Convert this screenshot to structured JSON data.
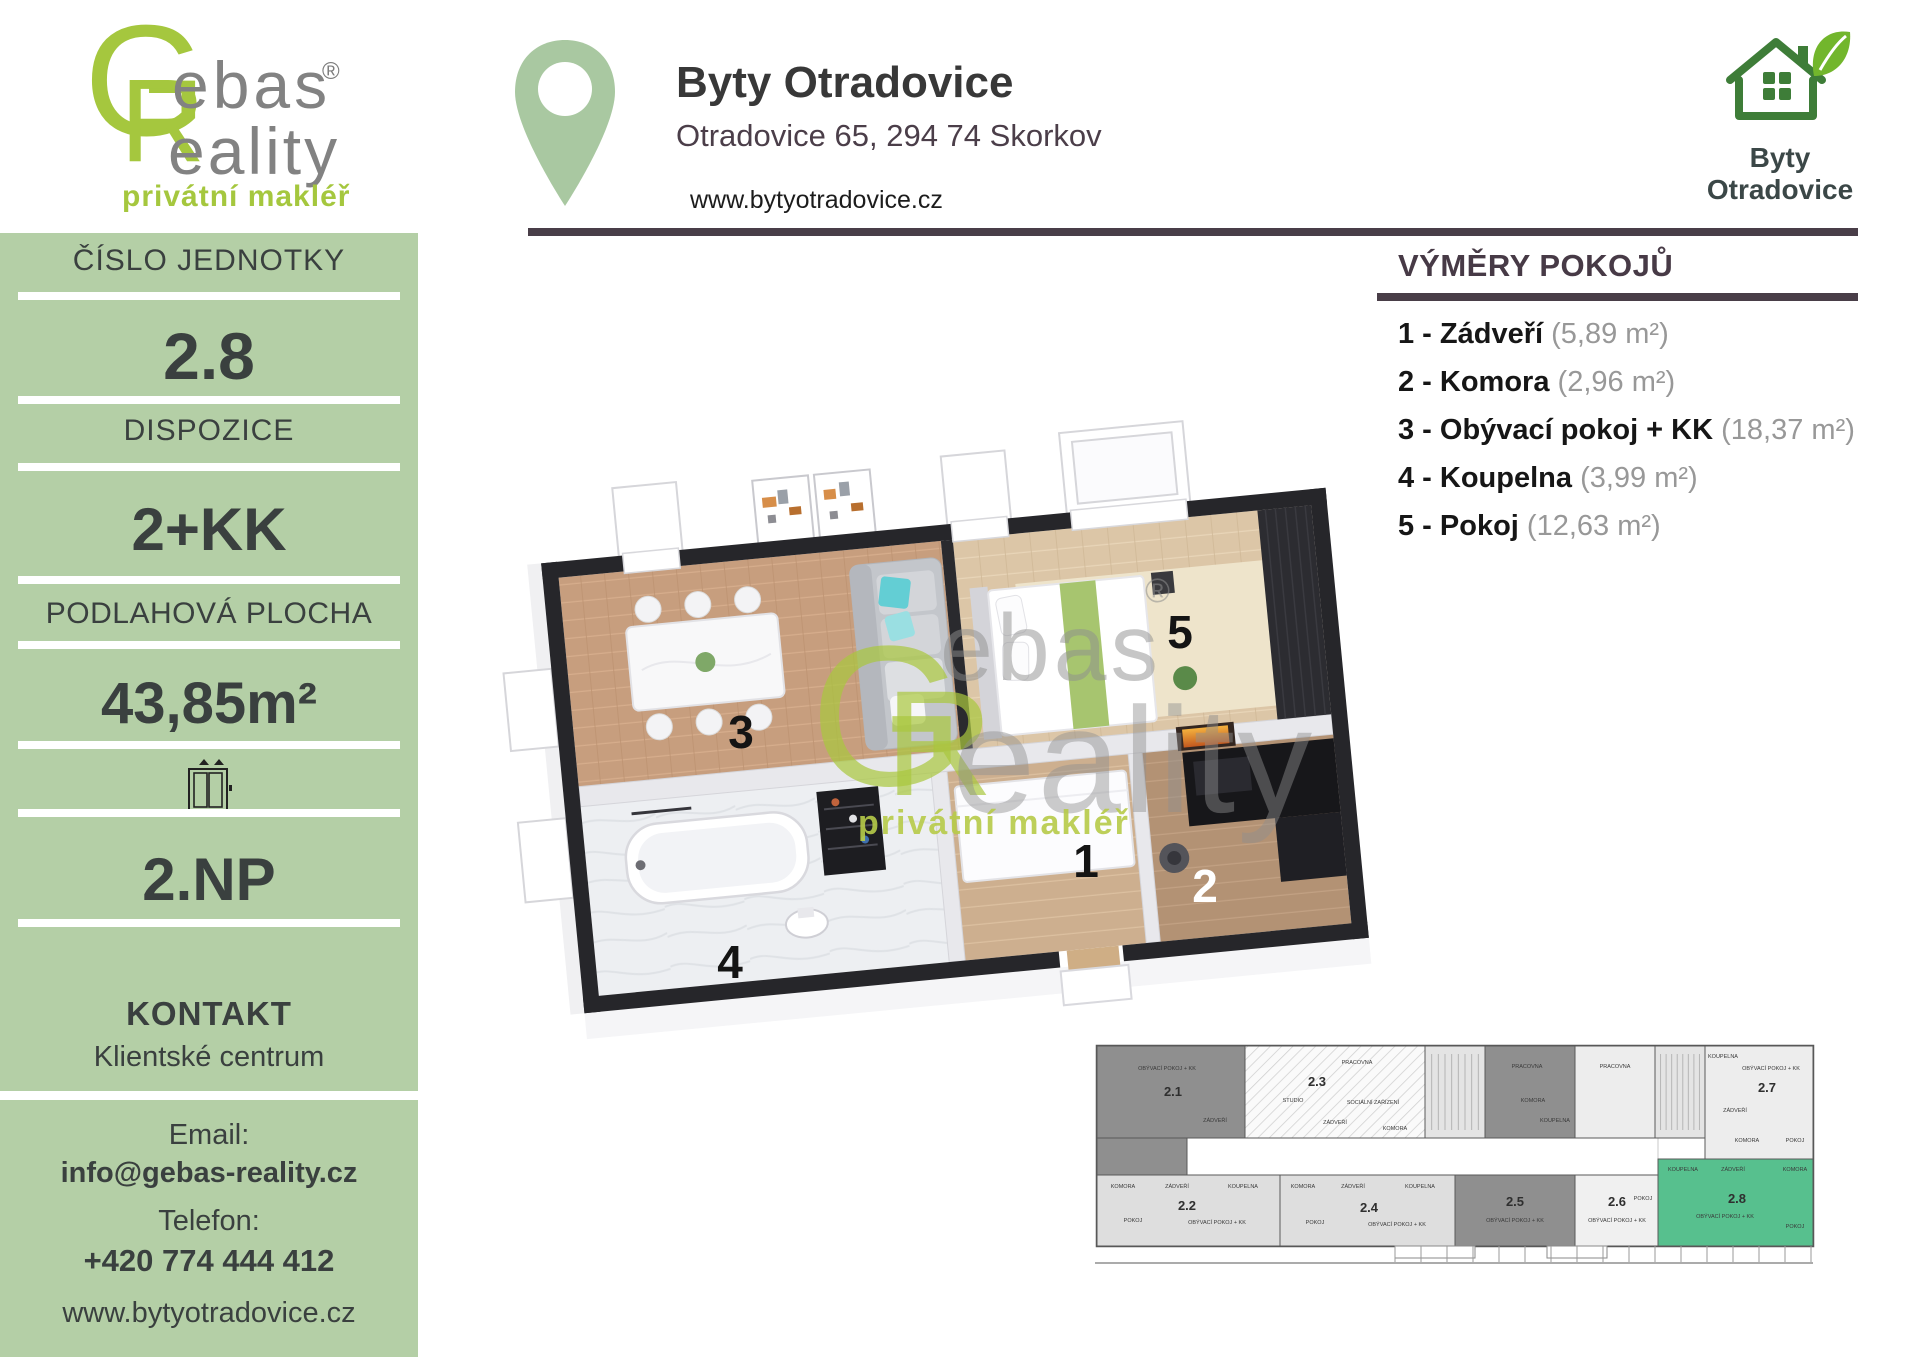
{
  "colors": {
    "sidebar_bg": "#b4cfa6",
    "accent_lime": "#a5c73e",
    "rule_dark": "#493e48",
    "logo_green": "#3e7d38",
    "leaf_green": "#72b62c",
    "pin_green": "#a9c8a1",
    "mini_unit_green": "#57c08e",
    "mini_unit_dark": "#8f8f8f"
  },
  "brand": {
    "monogram_g": "G",
    "monogram_r": "R",
    "word_top": "ebas",
    "word_bottom": "eality",
    "registered": "®",
    "tagline": "privátní makléř"
  },
  "header": {
    "title": "Byty Otradovice",
    "address": "Otradovice 65, 294 74 Skorkov",
    "website": "www.bytyotradovice.cz"
  },
  "logo_right": {
    "line1": "Byty",
    "line2": "Otradovice"
  },
  "sidebar": {
    "unit_label": "ČÍSLO JEDNOTKY",
    "unit_value": "2.8",
    "layout_label": "DISPOZICE",
    "layout_value": "2+KK",
    "area_label": "PODLAHOVÁ PLOCHA",
    "area_value": "43,85m²",
    "floor_value": "2.NP",
    "contact_label": "KONTAKT",
    "contact_name": "Klientské centrum",
    "email_label": "Email:",
    "email": "info@gebas-reality.cz",
    "phone_label": "Telefon:",
    "phone": "+420 774 444 412",
    "website": "www.bytyotradovice.cz"
  },
  "rooms_section": {
    "title": "VÝMĚRY POKOJŮ",
    "items": [
      {
        "name": "1 - Zádveří",
        "area": "(5,89 m²)"
      },
      {
        "name": "2 - Komora",
        "area": "(2,96 m²)"
      },
      {
        "name": "3 - Obývací pokoj + KK",
        "area": "(18,37 m²)"
      },
      {
        "name": "4 - Koupelna",
        "area": "(3,99 m²)"
      },
      {
        "name": "5 - Pokoj",
        "area": "(12,63 m²)"
      }
    ]
  },
  "floor_plan": {
    "labels": [
      {
        "n": "3",
        "x": 251,
        "y": 308,
        "c": "#141414"
      },
      {
        "n": "5",
        "x": 690,
        "y": 208,
        "c": "#141414"
      },
      {
        "n": "4",
        "x": 240,
        "y": 538,
        "c": "#141414"
      },
      {
        "n": "1",
        "x": 596,
        "y": 437,
        "c": "#141414"
      },
      {
        "n": "2",
        "x": 715,
        "y": 462,
        "c": "#ffffff"
      }
    ],
    "watermark": {
      "g": "G",
      "r": "R",
      "word_top": "ebas",
      "word_bottom": "eality",
      "registered": "®",
      "tagline": "privátní makléř"
    }
  },
  "mini_plan": {
    "units": [
      {
        "id": "2.1",
        "x": 2,
        "y": 6,
        "w": 148,
        "h": 92,
        "fill": "#8f8f8f",
        "lx": 78,
        "ly": 56
      },
      {
        "id": "",
        "x": 2,
        "y": 98,
        "w": 90,
        "h": 37,
        "fill": "#8f8f8f"
      },
      {
        "id": "2.3",
        "x": 150,
        "y": 6,
        "w": 180,
        "h": 92,
        "fill": "hatch",
        "lx": 222,
        "ly": 46
      },
      {
        "id": "",
        "x": 330,
        "y": 6,
        "w": 60,
        "h": 92,
        "fill": "#e4e4e4",
        "stairs": true
      },
      {
        "id": "",
        "x": 390,
        "y": 6,
        "w": 90,
        "h": 92,
        "fill": "#8f8f8f"
      },
      {
        "id": "",
        "x": 480,
        "y": 6,
        "w": 80,
        "h": 92,
        "fill": "#ededed"
      },
      {
        "id": "",
        "x": 560,
        "y": 6,
        "w": 50,
        "h": 92,
        "fill": "#e4e4e4",
        "stairs": true
      },
      {
        "id": "2.7",
        "x": 610,
        "y": 6,
        "w": 108,
        "h": 113,
        "fill": "#ededed",
        "lx": 672,
        "ly": 52
      },
      {
        "id": "2.2",
        "x": 2,
        "y": 135,
        "w": 183,
        "h": 71,
        "fill": "#dedede",
        "lx": 92,
        "ly": 170
      },
      {
        "id": "2.4",
        "x": 185,
        "y": 135,
        "w": 175,
        "h": 71,
        "fill": "#dedede",
        "lx": 274,
        "ly": 172
      },
      {
        "id": "2.5",
        "x": 360,
        "y": 135,
        "w": 120,
        "h": 71,
        "fill": "#8f8f8f",
        "lx": 420,
        "ly": 166
      },
      {
        "id": "2.6",
        "x": 480,
        "y": 135,
        "w": 83,
        "h": 71,
        "fill": "#f0f0f0",
        "lx": 522,
        "ly": 166
      },
      {
        "id": "2.8",
        "x": 563,
        "y": 119,
        "w": 155,
        "h": 87,
        "fill": "#57c08e",
        "lx": 642,
        "ly": 163
      }
    ],
    "room_labels": [
      {
        "t": "OBÝVACÍ POKOJ + KK",
        "x": 72,
        "y": 30
      },
      {
        "t": "ZÁDVEŘÍ",
        "x": 120,
        "y": 82
      },
      {
        "t": "STUDIO",
        "x": 198,
        "y": 62
      },
      {
        "t": "PRACOVNA",
        "x": 262,
        "y": 24
      },
      {
        "t": "SOCIÁLNÍ ZAŘÍZENÍ",
        "x": 278,
        "y": 64
      },
      {
        "t": "ZÁDVEŘÍ",
        "x": 240,
        "y": 84
      },
      {
        "t": "KOMORA",
        "x": 300,
        "y": 90
      },
      {
        "t": "PRACOVNA",
        "x": 432,
        "y": 28
      },
      {
        "t": "PRACOVNA",
        "x": 520,
        "y": 28
      },
      {
        "t": "KOMORA",
        "x": 438,
        "y": 62
      },
      {
        "t": "KOUPELNA",
        "x": 460,
        "y": 82
      },
      {
        "t": "KOUPELNA",
        "x": 628,
        "y": 18
      },
      {
        "t": "OBÝVACÍ POKOJ + KK",
        "x": 676,
        "y": 30
      },
      {
        "t": "ZÁDVEŘÍ",
        "x": 640,
        "y": 72
      },
      {
        "t": "KOMORA",
        "x": 652,
        "y": 102
      },
      {
        "t": "POKOJ",
        "x": 700,
        "y": 102
      },
      {
        "t": "KOMORA",
        "x": 28,
        "y": 148
      },
      {
        "t": "ZÁDVEŘÍ",
        "x": 82,
        "y": 148
      },
      {
        "t": "KOUPELNA",
        "x": 148,
        "y": 148
      },
      {
        "t": "POKOJ",
        "x": 38,
        "y": 182
      },
      {
        "t": "OBÝVACÍ POKOJ + KK",
        "x": 122,
        "y": 184
      },
      {
        "t": "KOMORA",
        "x": 208,
        "y": 148
      },
      {
        "t": "ZÁDVEŘÍ",
        "x": 258,
        "y": 148
      },
      {
        "t": "KOUPELNA",
        "x": 325,
        "y": 148
      },
      {
        "t": "POKOJ",
        "x": 220,
        "y": 184
      },
      {
        "t": "OBÝVACÍ POKOJ + KK",
        "x": 302,
        "y": 186
      },
      {
        "t": "OBÝVACÍ POKOJ + KK",
        "x": 420,
        "y": 182
      },
      {
        "t": "OBÝVACÍ POKOJ + KK",
        "x": 522,
        "y": 182
      },
      {
        "t": "POKOJ",
        "x": 548,
        "y": 160
      },
      {
        "t": "KOUPELNA",
        "x": 588,
        "y": 131
      },
      {
        "t": "ZÁDVEŘÍ",
        "x": 638,
        "y": 131
      },
      {
        "t": "KOMORA",
        "x": 700,
        "y": 131
      },
      {
        "t": "OBÝVACÍ POKOJ + KK",
        "x": 630,
        "y": 178
      },
      {
        "t": "POKOJ",
        "x": 700,
        "y": 188
      }
    ]
  }
}
